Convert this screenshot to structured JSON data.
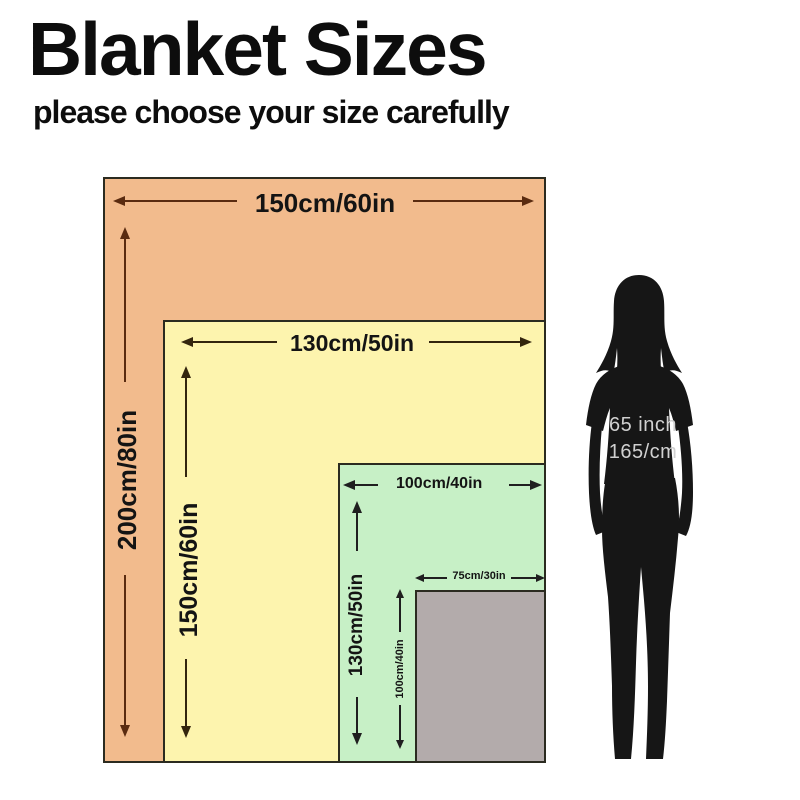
{
  "title": "Blanket Sizes",
  "subtitle": "please choose your size carefully",
  "blankets": [
    {
      "width_label": "150cm/60in",
      "height_label": "200cm/80in",
      "fill": "#f2bb8d"
    },
    {
      "width_label": "130cm/50in",
      "height_label": "150cm/60in",
      "fill": "#fdf4ae"
    },
    {
      "width_label": "100cm/40in",
      "height_label": "130cm/50in",
      "fill": "#c7f0c6"
    },
    {
      "width_label": "75cm/30in",
      "height_label": "100cm/40in",
      "fill": "#b3abab"
    }
  ],
  "person": {
    "height_line1": "65 inch",
    "height_line2": "165/cm",
    "silhouette_color": "#161616"
  },
  "colors": {
    "background": "#ffffff",
    "label_text": "#141414",
    "rect_border": "#2b2b20",
    "arrow_on_orange": "#5a2b10",
    "arrow_on_yellow": "#33250e",
    "arrow_on_green": "#1f1f1f",
    "person_text": "#d0d0d0"
  }
}
